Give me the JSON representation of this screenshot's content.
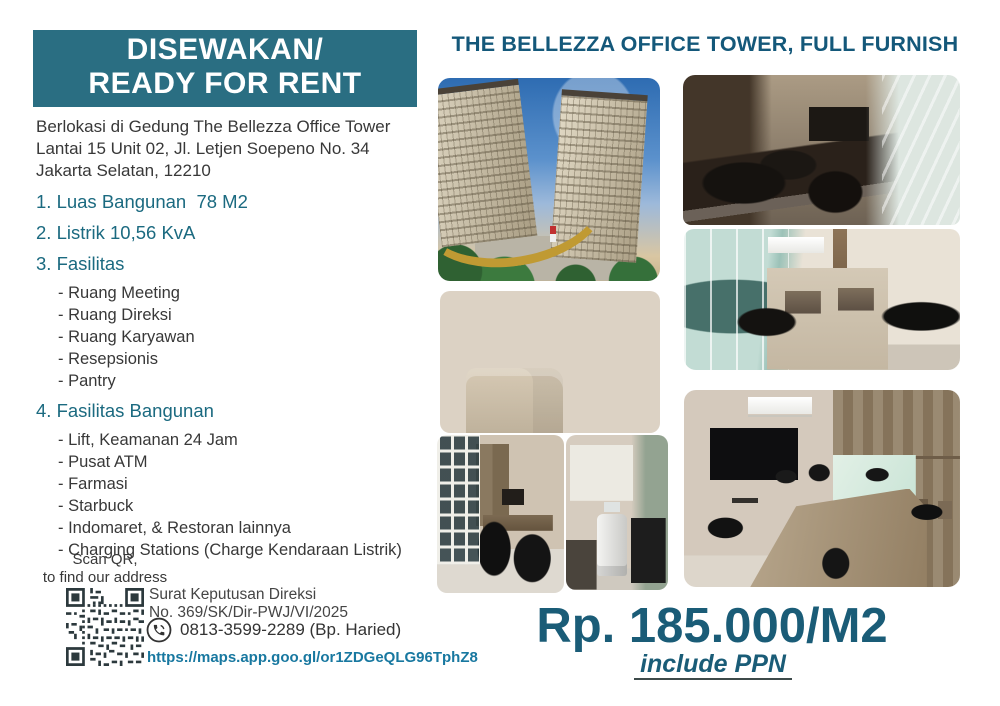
{
  "colors": {
    "accent_teal": "#2a6e82",
    "heading_blue": "#14587a",
    "list_teal": "#1b6a80",
    "body_dark": "#383838",
    "link_teal": "#1878a0",
    "price_teal": "#1a5c77",
    "qr_dark": "#2c393d"
  },
  "header": {
    "line1": "DISEWAKAN/",
    "line2": "READY FOR RENT"
  },
  "location": {
    "lines": [
      "Berlokasi di Gedung The Bellezza Office Tower",
      "Lantai 15 Unit 02, Jl. Letjen Soepeno No. 34",
      "Jakarta Selatan, 12210"
    ]
  },
  "specs": [
    {
      "label": "1. Luas Bangunan  78 M2",
      "items": []
    },
    {
      "label": "2. Listrik 10,56 KvA",
      "items": []
    },
    {
      "label": "3. Fasilitas",
      "items": [
        "- Ruang Meeting",
        "- Ruang Direksi",
        "- Ruang Karyawan",
        "- Resepsionis",
        "- Pantry"
      ]
    },
    {
      "label": "4. Fasilitas Bangunan",
      "items": [
        "- Lift, Keamanan 24 Jam",
        "- Pusat ATM",
        "- Farmasi",
        "- Starbuck",
        "- Indomaret, & Restoran lainnya",
        "- Charging Stations (Charge Kendaraan Listrik)"
      ]
    }
  ],
  "qr": {
    "caption_line1": "Scan QR,",
    "caption_line2": "to find our address",
    "icon": "qr-code"
  },
  "decree": {
    "line1": "Surat Keputusan Direksi",
    "line2": "No. 369/SK/Dir-PWJ/VI/2025"
  },
  "contact": {
    "phone_icon": "phone-icon",
    "phone": "0813-3599-2289 (Bp. Haried)",
    "map_link": "https://maps.app.goo.gl/or1ZDGeQLG96TphZ8"
  },
  "right": {
    "title": "THE BELLEZZA OFFICE TOWER, FULL FURNISH",
    "price": "Rp. 185.000/M2",
    "price_note": "include PPN"
  }
}
